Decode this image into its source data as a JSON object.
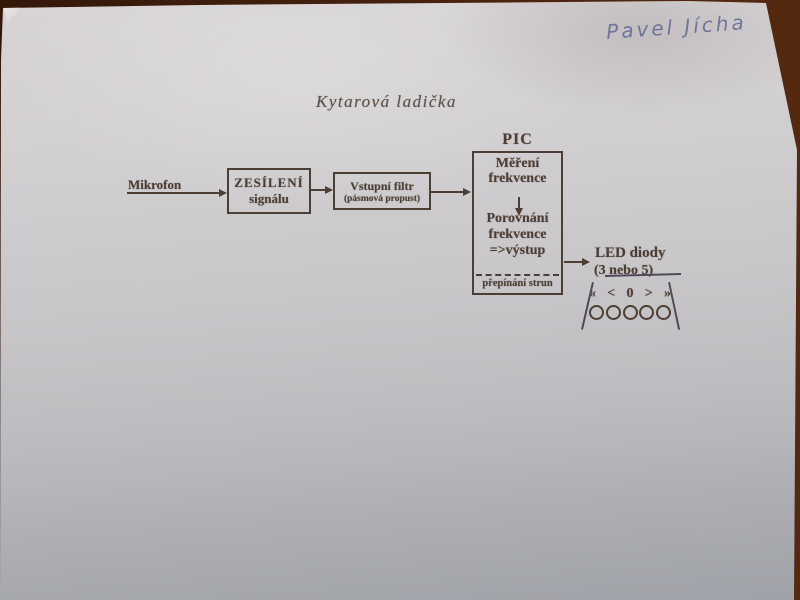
{
  "photo": {
    "handwritten_name": "Pavel Jícha",
    "ink_color": "#4c3e35",
    "pen_color": "#636a96",
    "paper_color_top": "#d8d4d5",
    "paper_color_bottom": "#9fa2a8",
    "table_color": "#48220f"
  },
  "title": "Kytarová ladička",
  "diagram": {
    "microphone_label": "Mikrofon",
    "amp_box": {
      "line1": "ZESÍLENÍ",
      "line2": "signálu"
    },
    "filter_box": {
      "line1": "Vstupní filtr",
      "line2": "(pásmová propust)"
    },
    "pic_label": "PIC",
    "pic_box": {
      "measure_line1": "Měření",
      "measure_line2": "frekvence",
      "compare_line1": "Porovnání",
      "compare_line2": "frekvence",
      "output_line": "=>výstup",
      "footer": "přepínání strun"
    },
    "led_label_line1": "LED diody",
    "led_label_line2_prefix": "(3 ",
    "led_label_line2_struck": "nebo 5)",
    "led_symbols": [
      "«",
      "<",
      "0",
      ">",
      "»"
    ],
    "led_count": 5
  }
}
